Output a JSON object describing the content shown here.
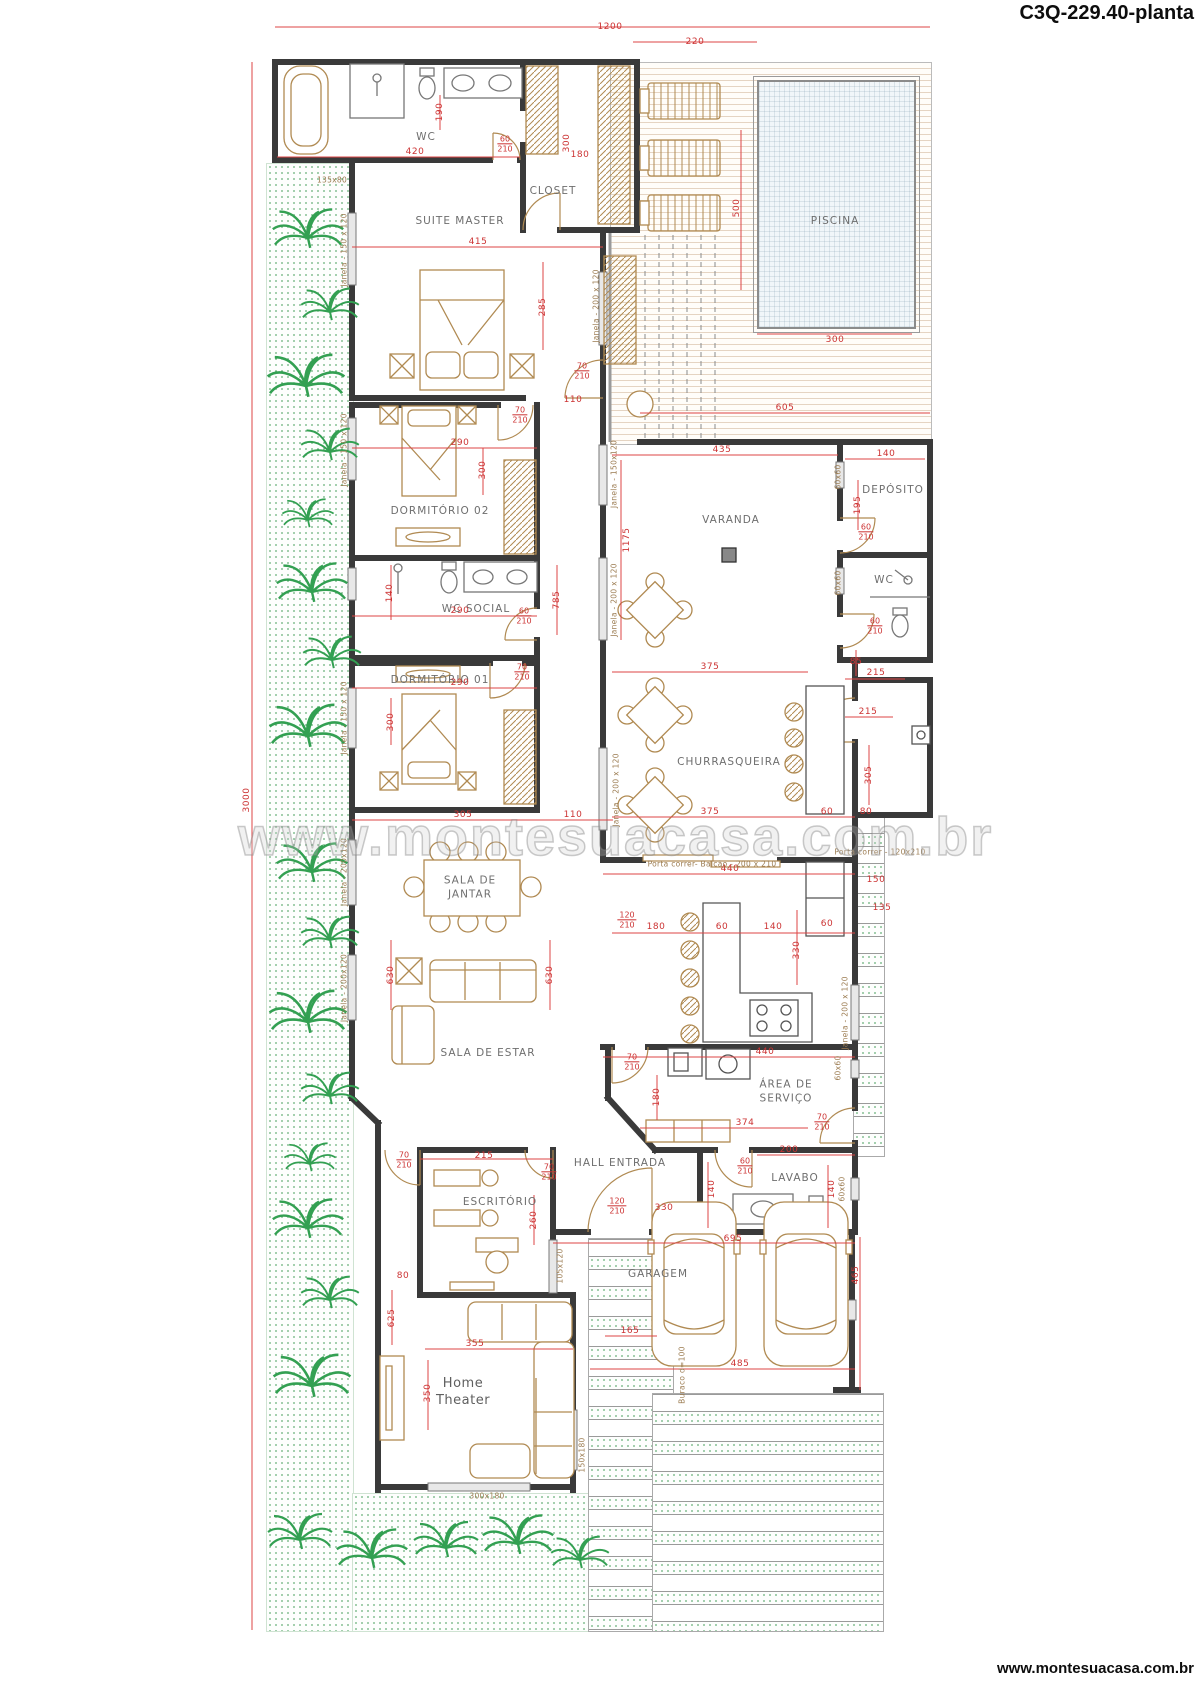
{
  "header": {
    "title": "C3Q-229.40-planta"
  },
  "footer": {
    "url": "www.montesuacasa.com.br"
  },
  "watermark": {
    "text": "www.montesuacasa.com.br"
  },
  "plan": {
    "room_labels": [
      {
        "lines": [
          "WC"
        ],
        "x": 426,
        "y": 138
      },
      {
        "lines": [
          "CLOSET"
        ],
        "x": 553,
        "y": 192
      },
      {
        "lines": [
          "SUITE MASTER"
        ],
        "x": 460,
        "y": 222
      },
      {
        "lines": [
          "DORMITÓRIO 02"
        ],
        "x": 440,
        "y": 512
      },
      {
        "lines": [
          "WC  SOCIAL"
        ],
        "x": 476,
        "y": 610
      },
      {
        "lines": [
          "DORMITÓRIO 01"
        ],
        "x": 440,
        "y": 681
      },
      {
        "lines": [
          "PISCINA"
        ],
        "x": 835,
        "y": 222
      },
      {
        "lines": [
          "VARANDA"
        ],
        "x": 731,
        "y": 521
      },
      {
        "lines": [
          "DEPÓSITO"
        ],
        "x": 893,
        "y": 491
      },
      {
        "lines": [
          "WC"
        ],
        "x": 884,
        "y": 581
      },
      {
        "lines": [
          "CHURRASQUEIRA"
        ],
        "x": 729,
        "y": 763
      },
      {
        "lines": [
          "SALA DE",
          "JANTAR"
        ],
        "x": 470,
        "y": 888
      },
      {
        "lines": [
          "SALA DE ESTAR"
        ],
        "x": 488,
        "y": 1054
      },
      {
        "lines": [
          "ÁREA DE",
          "SERVIÇO"
        ],
        "x": 786,
        "y": 1092
      },
      {
        "lines": [
          "HALL  ENTRADA"
        ],
        "x": 620,
        "y": 1164
      },
      {
        "lines": [
          "LAVABO"
        ],
        "x": 795,
        "y": 1179
      },
      {
        "lines": [
          "ESCRITÓRIO"
        ],
        "x": 500,
        "y": 1203
      },
      {
        "lines": [
          "GARAGEM"
        ],
        "x": 658,
        "y": 1275
      },
      {
        "lines": [
          "Home",
          "Theater"
        ],
        "x": 463,
        "y": 1393,
        "cls": "ht"
      }
    ],
    "dim_labels": [
      {
        "text": "1200",
        "x": 610,
        "y": 27
      },
      {
        "text": "220",
        "x": 695,
        "y": 42
      },
      {
        "text": "3000",
        "x": 247,
        "y": 800,
        "rot": -90
      },
      {
        "text": "420",
        "x": 415,
        "y": 152
      },
      {
        "text": "190",
        "x": 440,
        "y": 112,
        "rot": -90
      },
      {
        "text": "300",
        "x": 567,
        "y": 143,
        "rot": -90
      },
      {
        "text": "180",
        "x": 580,
        "y": 155
      },
      {
        "text": "500",
        "x": 737,
        "y": 208,
        "rot": -90
      },
      {
        "text": "300",
        "x": 835,
        "y": 340
      },
      {
        "text": "605",
        "x": 785,
        "y": 408
      },
      {
        "text": "435",
        "x": 722,
        "y": 450
      },
      {
        "text": "415",
        "x": 478,
        "y": 242
      },
      {
        "text": "285",
        "x": 543,
        "y": 307,
        "rot": -90
      },
      {
        "text": "110",
        "x": 573,
        "y": 400
      },
      {
        "text": "290",
        "x": 460,
        "y": 443
      },
      {
        "text": "300",
        "x": 483,
        "y": 470,
        "rot": -90
      },
      {
        "text": "290",
        "x": 460,
        "y": 611
      },
      {
        "text": "140",
        "x": 390,
        "y": 593,
        "rot": -90
      },
      {
        "text": "785",
        "x": 557,
        "y": 600,
        "rot": -90
      },
      {
        "text": "290",
        "x": 460,
        "y": 683
      },
      {
        "text": "300",
        "x": 391,
        "y": 722,
        "rot": -90
      },
      {
        "text": "305",
        "x": 463,
        "y": 815
      },
      {
        "text": "110",
        "x": 573,
        "y": 815
      },
      {
        "text": "1175",
        "x": 627,
        "y": 540,
        "rot": -90
      },
      {
        "text": "140",
        "x": 886,
        "y": 454
      },
      {
        "text": "195",
        "x": 858,
        "y": 505,
        "rot": -90
      },
      {
        "text": "85",
        "x": 856,
        "y": 662
      },
      {
        "text": "215",
        "x": 876,
        "y": 673
      },
      {
        "text": "215",
        "x": 868,
        "y": 712
      },
      {
        "text": "305",
        "x": 869,
        "y": 775,
        "rot": -90
      },
      {
        "text": "375",
        "x": 710,
        "y": 667
      },
      {
        "text": "375",
        "x": 710,
        "y": 812
      },
      {
        "text": "60",
        "x": 827,
        "y": 812
      },
      {
        "text": "80",
        "x": 866,
        "y": 812
      },
      {
        "text": "630",
        "x": 391,
        "y": 975,
        "rot": -90
      },
      {
        "text": "630",
        "x": 550,
        "y": 975,
        "rot": -90
      },
      {
        "text": "440",
        "x": 730,
        "y": 869
      },
      {
        "text": "180",
        "x": 656,
        "y": 927
      },
      {
        "text": "60",
        "x": 722,
        "y": 927
      },
      {
        "text": "140",
        "x": 773,
        "y": 927
      },
      {
        "text": "60",
        "x": 827,
        "y": 924
      },
      {
        "text": "330",
        "x": 797,
        "y": 950,
        "rot": -90
      },
      {
        "text": "440",
        "x": 765,
        "y": 1052
      },
      {
        "text": "180",
        "x": 657,
        "y": 1097,
        "rot": -90
      },
      {
        "text": "374",
        "x": 745,
        "y": 1123
      },
      {
        "text": "200",
        "x": 789,
        "y": 1150
      },
      {
        "text": "140",
        "x": 712,
        "y": 1189,
        "rot": -90
      },
      {
        "text": "140",
        "x": 832,
        "y": 1189,
        "rot": -90
      },
      {
        "text": "330",
        "x": 664,
        "y": 1208
      },
      {
        "text": "695",
        "x": 733,
        "y": 1239
      },
      {
        "text": "215",
        "x": 484,
        "y": 1156
      },
      {
        "text": "260",
        "x": 534,
        "y": 1220,
        "rot": -90
      },
      {
        "text": "80",
        "x": 403,
        "y": 1276
      },
      {
        "text": "625",
        "x": 392,
        "y": 1318,
        "rot": -90
      },
      {
        "text": "355",
        "x": 475,
        "y": 1344
      },
      {
        "text": "350",
        "x": 428,
        "y": 1393,
        "rot": -90
      },
      {
        "text": "165",
        "x": 630,
        "y": 1331
      },
      {
        "text": "485",
        "x": 740,
        "y": 1364
      },
      {
        "text": "465",
        "x": 856,
        "y": 1275,
        "rot": -90
      },
      {
        "text": "150",
        "x": 876,
        "y": 880
      },
      {
        "text": "135",
        "x": 882,
        "y": 908
      }
    ],
    "door_labels": [
      {
        "top": "60",
        "bottom": "210",
        "x": 505,
        "y": 144
      },
      {
        "top": "70",
        "bottom": "210",
        "x": 582,
        "y": 371
      },
      {
        "top": "70",
        "bottom": "210",
        "x": 520,
        "y": 415
      },
      {
        "top": "60",
        "bottom": "210",
        "x": 524,
        "y": 616
      },
      {
        "top": "70",
        "bottom": "210",
        "x": 522,
        "y": 672
      },
      {
        "top": "60",
        "bottom": "210",
        "x": 866,
        "y": 532
      },
      {
        "top": "60",
        "bottom": "210",
        "x": 875,
        "y": 626
      },
      {
        "top": "120",
        "bottom": "210",
        "x": 627,
        "y": 920
      },
      {
        "top": "70",
        "bottom": "210",
        "x": 632,
        "y": 1062
      },
      {
        "top": "70",
        "bottom": "210",
        "x": 822,
        "y": 1122
      },
      {
        "top": "60",
        "bottom": "210",
        "x": 745,
        "y": 1166
      },
      {
        "top": "120",
        "bottom": "210",
        "x": 617,
        "y": 1206
      },
      {
        "top": "70",
        "bottom": "210",
        "x": 404,
        "y": 1160
      },
      {
        "top": "70",
        "bottom": "210",
        "x": 549,
        "y": 1172
      }
    ],
    "window_labels": [
      {
        "text": "135x80",
        "x": 332,
        "y": 180
      },
      {
        "text": "Janela - 150 x 120",
        "x": 344,
        "y": 250,
        "rot": -90
      },
      {
        "text": "Janela - 200 x 120",
        "x": 596,
        "y": 306,
        "rot": -90
      },
      {
        "text": "Janela - 150 x 120",
        "x": 344,
        "y": 450,
        "rot": -90
      },
      {
        "text": "Janela - 150 x 120",
        "x": 344,
        "y": 718,
        "rot": -90
      },
      {
        "text": "Janela - 150x120",
        "x": 614,
        "y": 474,
        "rot": -90
      },
      {
        "text": "Janela - 200 x 120",
        "x": 614,
        "y": 600,
        "rot": -90
      },
      {
        "text": "Janela - 200 x 120",
        "x": 616,
        "y": 790,
        "rot": -90
      },
      {
        "text": "Janela - 200x120",
        "x": 344,
        "y": 872,
        "rot": -90
      },
      {
        "text": "Janela - 200x120",
        "x": 344,
        "y": 988,
        "rot": -90
      },
      {
        "text": "Janela - 200 x 120",
        "x": 845,
        "y": 1013,
        "rot": -90
      },
      {
        "text": "60x60",
        "x": 838,
        "y": 477,
        "rot": -90
      },
      {
        "text": "60x60",
        "x": 838,
        "y": 583,
        "rot": -90
      },
      {
        "text": "60x60",
        "x": 838,
        "y": 1068,
        "rot": -90
      },
      {
        "text": "60x60",
        "x": 842,
        "y": 1189,
        "rot": -90
      },
      {
        "text": "Porta correr- Balcão - 200 x 210",
        "x": 712,
        "y": 864
      },
      {
        "text": "Porta correr - 120x210",
        "x": 880,
        "y": 852
      },
      {
        "text": "105x120",
        "x": 560,
        "y": 1266,
        "rot": -90
      },
      {
        "text": "300x180",
        "x": 487,
        "y": 1496
      },
      {
        "text": "150x180",
        "x": 582,
        "y": 1455,
        "rot": -90
      },
      {
        "text": "Buraco d=100",
        "x": 682,
        "y": 1375,
        "rot": -90
      }
    ]
  }
}
